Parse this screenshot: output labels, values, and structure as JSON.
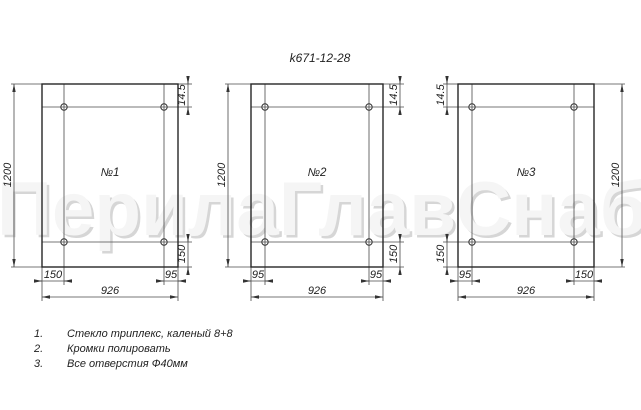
{
  "doc_number": "k671-12-28",
  "watermark": "ПерилаГлавСнаб",
  "panels": [
    {
      "label": "№1",
      "dims": {
        "height": "1200",
        "width": "926",
        "top_hole": "14.5",
        "bottom_hole": "150",
        "left_hole": "150",
        "right_hole": "95"
      }
    },
    {
      "label": "№2",
      "dims": {
        "height": "1200",
        "width": "926",
        "top_hole": "14.5",
        "bottom_hole": "150",
        "left_hole": "95",
        "right_hole": "95"
      }
    },
    {
      "label": "№3",
      "dims": {
        "height": "1200",
        "width": "926",
        "top_hole": "14.5",
        "bottom_hole": "150",
        "left_hole": "95",
        "right_hole": "150"
      }
    }
  ],
  "notes": [
    {
      "num": "1.",
      "text": "Стекло триплекс, каленый 8+8"
    },
    {
      "num": "2.",
      "text": "Кромки полировать"
    },
    {
      "num": "3.",
      "text": "Все отверстия Ф40мм"
    }
  ],
  "colors": {
    "line": "#262626",
    "thin_line": "#4a4a4a",
    "text": "#1f1f1f",
    "watermark_fill": "#f5f5f5",
    "watermark_shadow": "#d6d6d6",
    "background": "#ffffff"
  }
}
